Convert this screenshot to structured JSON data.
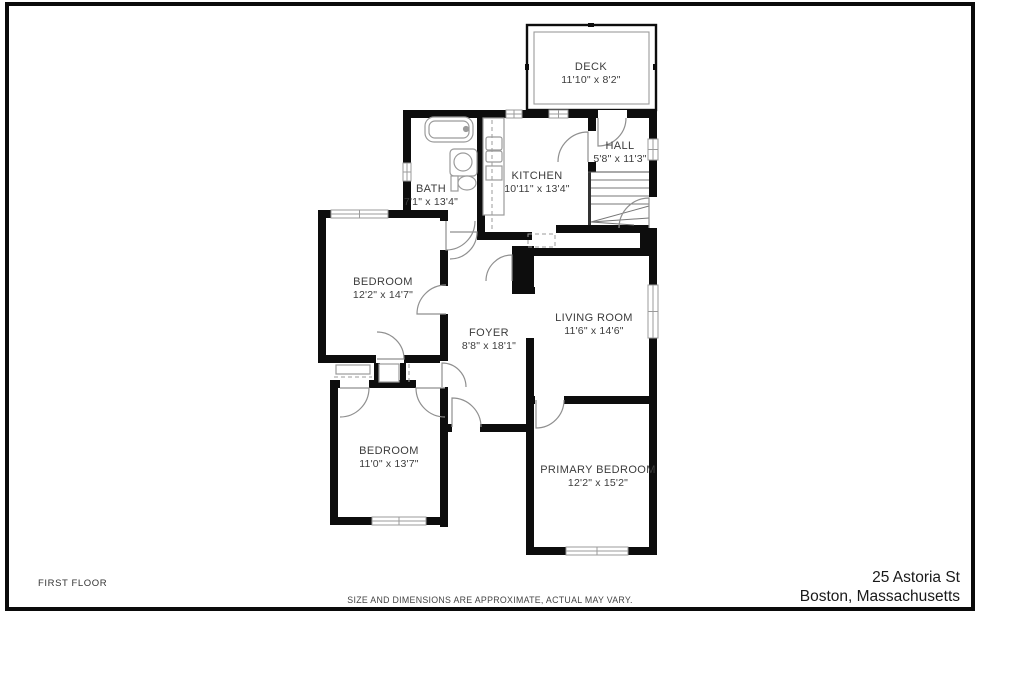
{
  "footer": {
    "floor_label": "FIRST FLOOR",
    "disclaimer": "SIZE AND DIMENSIONS ARE APPROXIMATE, ACTUAL MAY VARY.",
    "address_line1": "25 Astoria St",
    "address_line2": "Boston, Massachusetts"
  },
  "colors": {
    "wall": "#0d0d0d",
    "line": "#9b9b9b",
    "label": "#3c3c3c",
    "frame": "#0a0a0a"
  },
  "plan": {
    "deck": {
      "outer": [
        527,
        25,
        129,
        85
      ],
      "inner": [
        534,
        32,
        115,
        72
      ],
      "ticks": [
        [
          588,
          23,
          6,
          4
        ],
        [
          525,
          64,
          4,
          6
        ],
        [
          653,
          64,
          4,
          6
        ]
      ]
    },
    "walls": [
      [
        403,
        110,
        254,
        8
      ],
      [
        403,
        110,
        8,
        108
      ],
      [
        318,
        210,
        129,
        8
      ],
      [
        440,
        210,
        8,
        30
      ],
      [
        477,
        110,
        8,
        130
      ],
      [
        477,
        232,
        55,
        8
      ],
      [
        556,
        225,
        101,
        8
      ],
      [
        588,
        110,
        8,
        62
      ],
      [
        649,
        110,
        8,
        123
      ],
      [
        640,
        233,
        17,
        22
      ],
      [
        533,
        248,
        124,
        8
      ],
      [
        526,
        255,
        8,
        38
      ],
      [
        512,
        287,
        23,
        7
      ],
      [
        526,
        338,
        8,
        65
      ],
      [
        649,
        233,
        8,
        322
      ],
      [
        526,
        396,
        131,
        8
      ],
      [
        526,
        396,
        8,
        159
      ],
      [
        526,
        547,
        131,
        8
      ],
      [
        443,
        424,
        91,
        8
      ],
      [
        440,
        387,
        8,
        140
      ],
      [
        330,
        380,
        118,
        8
      ],
      [
        330,
        380,
        8,
        145
      ],
      [
        330,
        517,
        118,
        8
      ],
      [
        318,
        210,
        8,
        153
      ],
      [
        318,
        355,
        129,
        8
      ],
      [
        440,
        210,
        8,
        153
      ],
      [
        374,
        363,
        6,
        20
      ],
      [
        400,
        363,
        6,
        20
      ]
    ],
    "solids": [
      [
        512,
        246,
        22,
        47
      ]
    ],
    "gaps": [
      [
        598,
        110,
        29,
        8
      ],
      [
        588,
        131,
        8,
        31
      ],
      [
        649,
        197,
        8,
        31
      ],
      [
        535,
        396,
        29,
        8
      ],
      [
        452,
        424,
        28,
        8
      ],
      [
        340,
        380,
        29,
        8
      ],
      [
        416,
        380,
        29,
        8
      ],
      [
        376,
        355,
        28,
        8
      ],
      [
        440,
        221,
        8,
        29
      ],
      [
        440,
        286,
        8,
        28
      ],
      [
        440,
        361,
        8,
        26
      ]
    ],
    "windows": [
      {
        "x": 506,
        "y": 110,
        "w": 16,
        "h": 8,
        "o": "h"
      },
      {
        "x": 549,
        "y": 110,
        "w": 19,
        "h": 8,
        "o": "h"
      },
      {
        "x": 331,
        "y": 210,
        "w": 57,
        "h": 8,
        "o": "h"
      },
      {
        "x": 403,
        "y": 163,
        "w": 8,
        "h": 18,
        "o": "v"
      },
      {
        "x": 648,
        "y": 139,
        "w": 10,
        "h": 21,
        "o": "v"
      },
      {
        "x": 648,
        "y": 285,
        "w": 10,
        "h": 53,
        "o": "v"
      },
      {
        "x": 372,
        "y": 517,
        "w": 54,
        "h": 8,
        "o": "h"
      },
      {
        "x": 566,
        "y": 547,
        "w": 62,
        "h": 8,
        "o": "h"
      }
    ],
    "doors": [
      {
        "hx": 598,
        "hy": 118,
        "r": 28,
        "a1": 90,
        "a2": 0,
        "sweep": 0
      },
      {
        "hx": 588,
        "hy": 162,
        "r": 30,
        "a1": 270,
        "a2": 180,
        "sweep": 0
      },
      {
        "hx": 649,
        "hy": 228,
        "r": 30,
        "a1": 270,
        "a2": 180,
        "sweep": 0
      },
      {
        "hx": 450,
        "hy": 232,
        "r": 27,
        "a1": 0,
        "a2": 90,
        "sweep": 1
      },
      {
        "hx": 446,
        "hy": 221,
        "r": 29,
        "a1": 90,
        "a2": 0,
        "sweep": 0
      },
      {
        "hx": 446,
        "hy": 314,
        "r": 29,
        "a1": 180,
        "a2": 270,
        "sweep": 1
      },
      {
        "hx": 377,
        "hy": 359,
        "r": 27,
        "a1": 0,
        "a2": 270,
        "sweep": 0
      },
      {
        "hx": 442,
        "hy": 387,
        "r": 24,
        "a1": 270,
        "a2": 360,
        "sweep": 1
      },
      {
        "hx": 340,
        "hy": 388,
        "r": 29,
        "a1": 0,
        "a2": 90,
        "sweep": 1
      },
      {
        "hx": 445,
        "hy": 388,
        "r": 29,
        "a1": 180,
        "a2": 90,
        "sweep": 0
      },
      {
        "hx": 452,
        "hy": 427,
        "r": 29,
        "a1": 270,
        "a2": 360,
        "sweep": 1
      },
      {
        "hx": 536,
        "hy": 400,
        "r": 28,
        "a1": 90,
        "a2": 0,
        "sweep": 0
      },
      {
        "hx": 512,
        "hy": 281,
        "r": 26,
        "a1": 270,
        "a2": 180,
        "sweep": 0
      }
    ],
    "stairs": {
      "left": [
        588,
        172,
        3,
        53
      ],
      "top": [
        588,
        172,
        649,
        172
      ],
      "treads": [
        [
          591,
          180,
          649,
          180
        ],
        [
          591,
          188,
          649,
          188
        ],
        [
          591,
          196,
          649,
          196
        ],
        [
          591,
          204,
          649,
          204
        ]
      ],
      "fan": [
        [
          591,
          222,
          649,
          206
        ],
        [
          591,
          222,
          649,
          218
        ],
        [
          591,
          222,
          634,
          225
        ]
      ]
    },
    "shapes": [
      {
        "t": "rrect",
        "x": 425,
        "y": 117,
        "w": 48,
        "h": 25,
        "rx": 9,
        "n": "bathtub"
      },
      {
        "t": "rrect",
        "x": 429,
        "y": 121,
        "w": 40,
        "h": 17,
        "rx": 6,
        "n": "bathtub-inner"
      },
      {
        "t": "circle",
        "cx": 466,
        "cy": 129,
        "r": 2.5,
        "n": "tub-faucet"
      },
      {
        "t": "rrect",
        "x": 450,
        "y": 149,
        "w": 27,
        "h": 27,
        "rx": 4,
        "n": "vanity"
      },
      {
        "t": "circle",
        "cx": 463,
        "cy": 162,
        "r": 9,
        "n": "bath-sink"
      },
      {
        "t": "rect",
        "x": 451,
        "y": 176,
        "w": 7,
        "h": 15,
        "n": "toilet-tank"
      },
      {
        "t": "ellipse",
        "cx": 467,
        "cy": 183,
        "rx": 9,
        "ry": 7,
        "n": "toilet-bowl"
      },
      {
        "t": "rect",
        "x": 483,
        "y": 118,
        "w": 21,
        "h": 97,
        "n": "kitchen-counter"
      },
      {
        "t": "rrect",
        "x": 486,
        "y": 137,
        "w": 16,
        "h": 13,
        "rx": 2,
        "n": "kitchen-sink"
      },
      {
        "t": "rrect",
        "x": 486,
        "y": 151,
        "w": 16,
        "h": 11,
        "rx": 2,
        "n": "kitchen-sink-basin"
      },
      {
        "t": "rect",
        "x": 486,
        "y": 166,
        "w": 16,
        "h": 14,
        "n": "kitchen-appliance"
      },
      {
        "t": "rect",
        "x": 336,
        "y": 365,
        "w": 34,
        "h": 9,
        "n": "closet-shelf"
      },
      {
        "t": "rect",
        "x": 379,
        "y": 364,
        "w": 20,
        "h": 18,
        "n": "closet-cell"
      }
    ],
    "dashed_rects": [
      [
        528,
        234,
        27,
        13
      ]
    ],
    "dashed_lines": [
      [
        334,
        377,
        372,
        377
      ],
      [
        409,
        364,
        409,
        383
      ],
      [
        492,
        120,
        492,
        230
      ]
    ],
    "rooms": [
      {
        "name": "DECK",
        "dims": "11'10\" x 8'2\"",
        "x": 591,
        "y": 70
      },
      {
        "name": "BATH",
        "dims": "7'1\" x 13'4\"",
        "x": 431,
        "y": 192
      },
      {
        "name": "KITCHEN",
        "dims": "10'11\" x 13'4\"",
        "x": 537,
        "y": 179
      },
      {
        "name": "HALL",
        "dims": "5'8\" x 11'3\"",
        "x": 620,
        "y": 149
      },
      {
        "name": "BEDROOM",
        "dims": "12'2\" x 14'7\"",
        "x": 383,
        "y": 285
      },
      {
        "name": "FOYER",
        "dims": "8'8\" x 18'1\"",
        "x": 489,
        "y": 336
      },
      {
        "name": "LIVING ROOM",
        "dims": "11'6\" x 14'6\"",
        "x": 594,
        "y": 321
      },
      {
        "name": "BEDROOM",
        "dims": "11'0\" x 13'7\"",
        "x": 389,
        "y": 454
      },
      {
        "name": "PRIMARY BEDROOM",
        "dims": "12'2\" x 15'2\"",
        "x": 598,
        "y": 473
      }
    ]
  }
}
